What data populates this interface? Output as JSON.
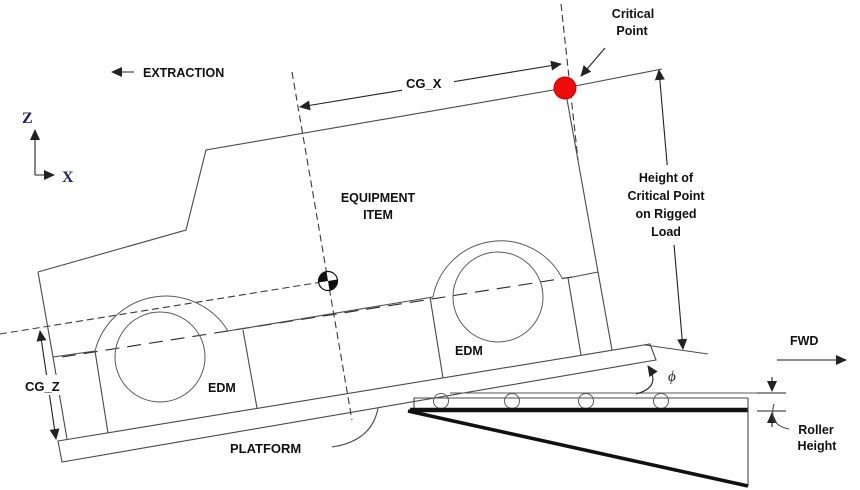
{
  "diagram": {
    "type": "engineering-extraction-rigging-schematic",
    "colors": {
      "line": "#4a4a4a",
      "text": "#111111",
      "critical_point_dot": "#ee0b0b",
      "axis_letters": "#202066"
    },
    "labels": {
      "extraction": "EXTRACTION",
      "axis_z": "Z",
      "axis_x": "X",
      "cg_x": "CG_X",
      "cg_z": "CG_Z",
      "equipment_line1": "EQUIPMENT",
      "equipment_line2": "ITEM",
      "critical_line1": "Critical",
      "critical_line2": "Point",
      "height_line1": "Height of",
      "height_line2": "Critical Point",
      "height_line3": "on Rigged",
      "height_line4": "Load",
      "fwd": "FWD",
      "edm_front": "EDM",
      "edm_rear": "EDM",
      "platform": "PLATFORM",
      "roller_line1": "Roller",
      "roller_line2": "Height",
      "phi": "ϕ"
    }
  }
}
